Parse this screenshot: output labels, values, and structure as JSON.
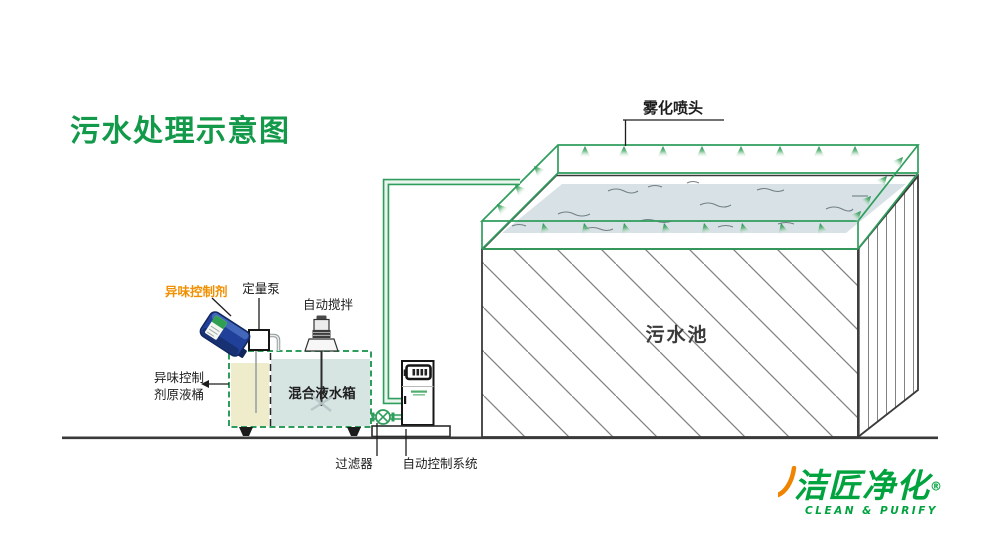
{
  "title": "污水处理示意图",
  "labels": {
    "spray_nozzles": "雾化喷头",
    "odor_control_agent": "异味控制剂",
    "metering_pump": "定量泵",
    "auto_stirrer": "自动搅拌",
    "mixing_tank": "混合液水箱",
    "agent_barrel_line1": "异味控制",
    "agent_barrel_line2": "剂原液桶",
    "sewage_pool": "污水池",
    "filter": "过滤器",
    "auto_control_system": "自动控制系统"
  },
  "logo": {
    "brand": "洁匠净化",
    "registered": "®",
    "tagline": "CLEAN & PURIFY"
  },
  "colors": {
    "diagram_green": "#2f9e5c",
    "title_green": "#13994a",
    "accent_orange": "#f09000",
    "logo_green": "#00a33e",
    "logo_orange": "#f08300",
    "barrel_blue": "#20409a",
    "pool_water": "#d8e2e6",
    "agent_liquid": "#efeccb",
    "mix_liquid": "#d6e4e2",
    "outline_dark": "#3a3a3a"
  }
}
